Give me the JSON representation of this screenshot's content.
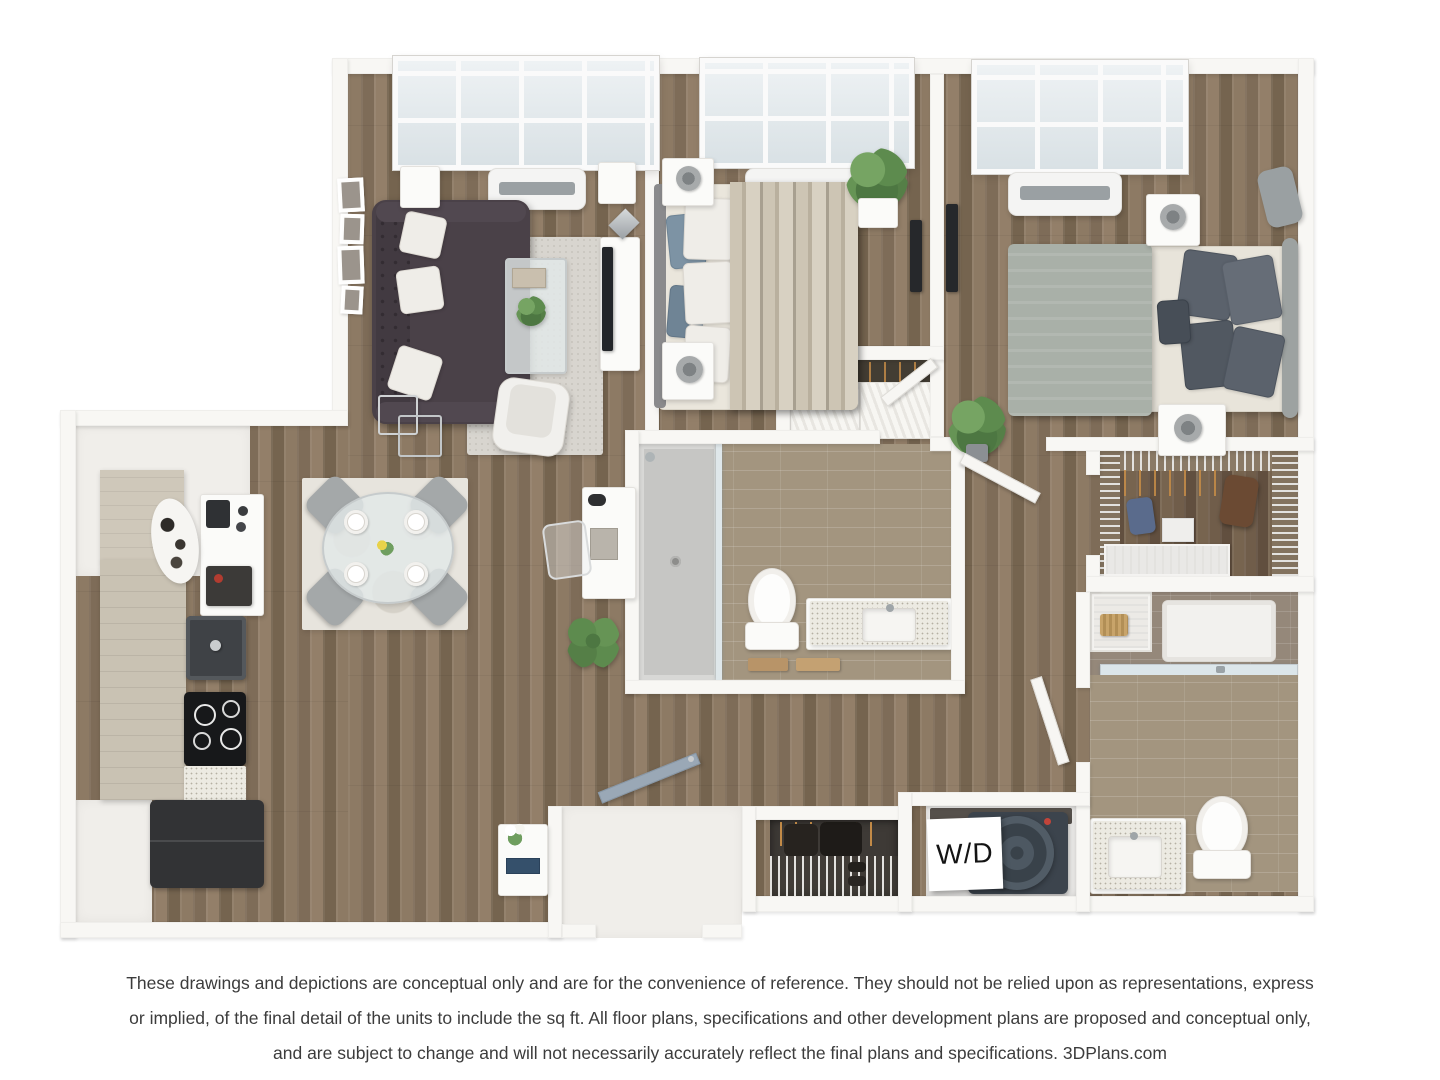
{
  "labels": {
    "washer_dryer": "W/D"
  },
  "footer": {
    "line1": "These drawings and depictions are conceptual only and are for the convenience of reference. They should not be relied upon as representations, express",
    "line2": "or implied, of the final detail of the units to include the sq ft. All floor plans, specifications and other development plans are proposed and conceptual only,",
    "line3": "and are subject to change and will not necessarily accurately reflect the final plans and specifications. 3DPlans.com"
  },
  "plan": {
    "type": "3d-floor-plan-top-view",
    "rooms": [
      "living-room",
      "dining-area",
      "kitchen",
      "home-office-nook",
      "bedroom-1",
      "bedroom-2",
      "bathroom-1",
      "bathroom-2",
      "walk-in-closet",
      "bedroom-1-closet",
      "coat-closet",
      "linen-closet",
      "laundry-closet",
      "entry"
    ],
    "colors": {
      "background": "#ffffff",
      "wall": "#f8f7f4",
      "wood_floor": "#87745f",
      "pale_floor": "#f0eeea",
      "bath_tile": "#a3957f",
      "living_rug": "#d8d5cf",
      "dining_rug": "#e7e4dd",
      "sofa": "#4a4148",
      "bed1_duvet": "#c7bfae",
      "bed2_blanket": "#a9b0a8",
      "accent_pillow_blue": "#7d93a4",
      "appliance_dark": "#323335",
      "plant_green": "#5d8b4e",
      "entry_door": "#9aa8b6",
      "footer_text": "#3c3c3c"
    }
  }
}
